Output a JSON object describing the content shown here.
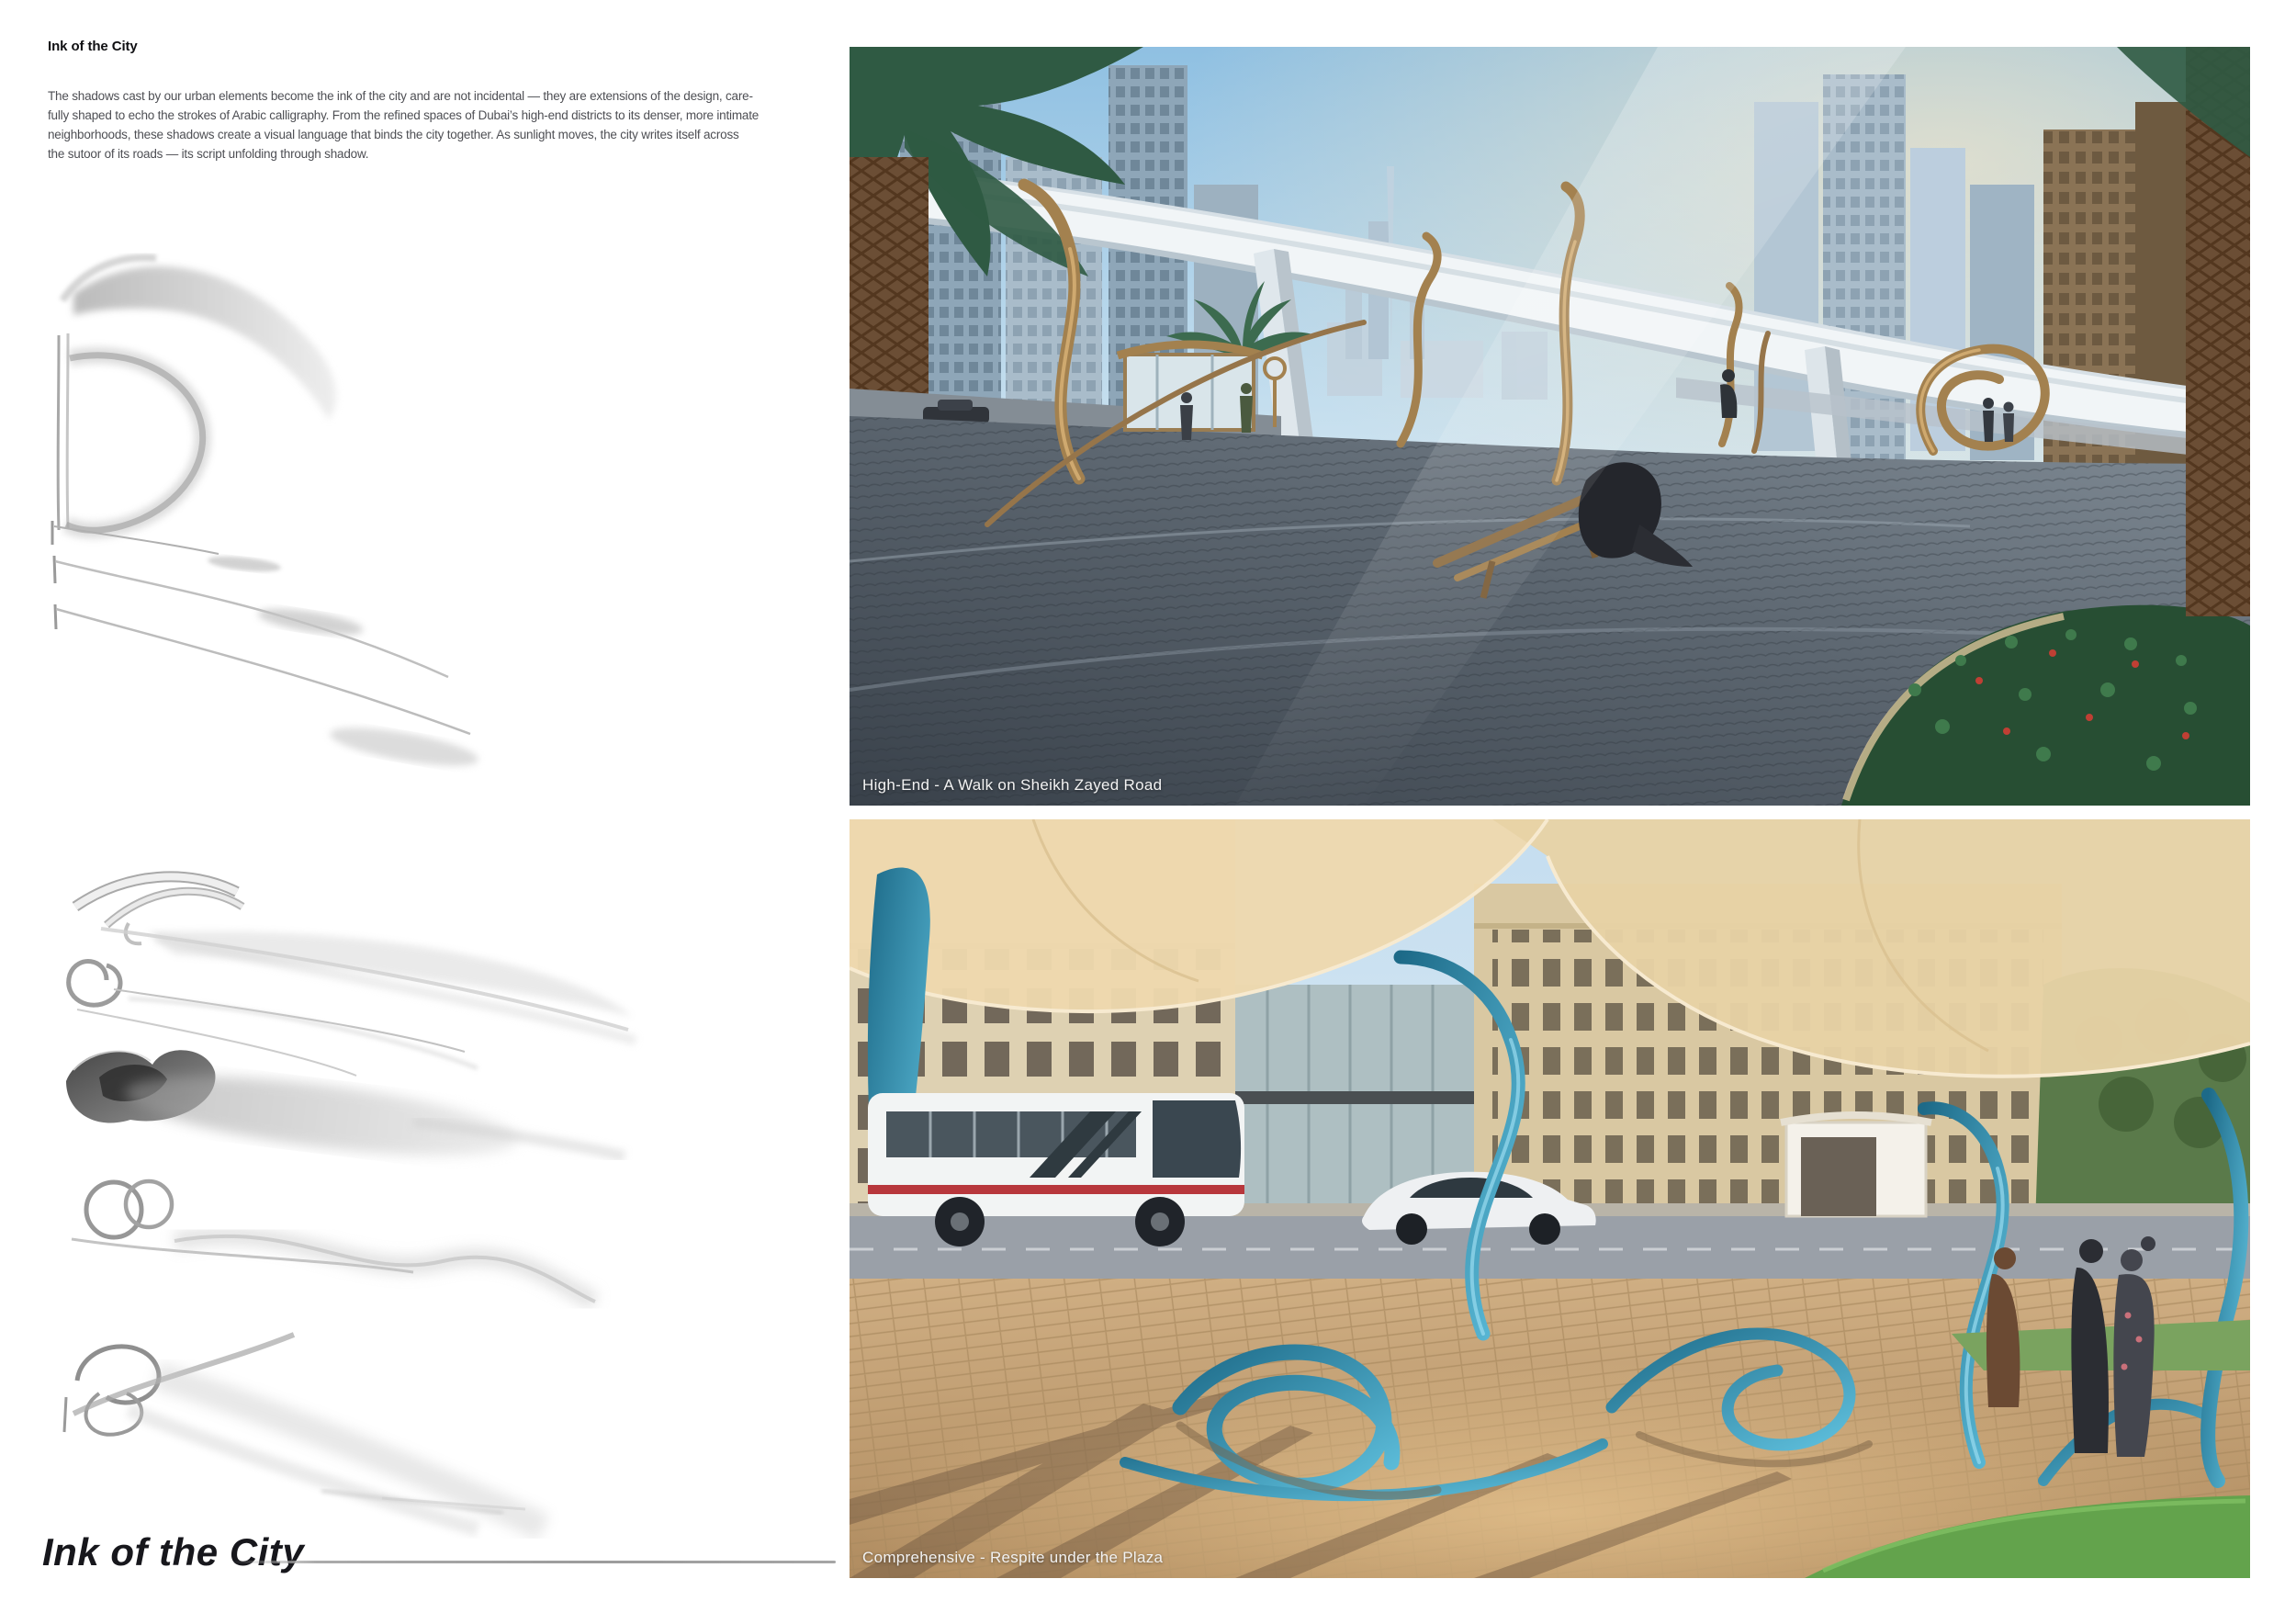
{
  "header": {
    "heading": "Ink of the City"
  },
  "intro": {
    "lines": [
      "The shadows cast by our urban elements become the ink of the city and are not incidental — they are extensions of the design, care-",
      "fully shaped to echo the strokes of Arabic calligraphy. From the refined spaces of Dubai’s high-end districts to its denser, more intimate",
      "neighborhoods, these shadows create a visual language that binds the city together. As sunlight moves, the city writes itself across",
      "the sutoor of its roads — its script unfolding through shadow."
    ]
  },
  "renders": {
    "high_end": {
      "caption": "High-End - A Walk on Sheikh Zayed Road"
    },
    "comprehensive": {
      "caption": "Comprehensive - Respite under the Plaza"
    }
  },
  "footer": {
    "title": "Ink of the City"
  },
  "colors": {
    "heading_text": "#101013",
    "body_text": "#4e4f54",
    "caption_text": "#f2f2f2",
    "rule_gray": "#a5a5a5",
    "bronze_sculpture": "#a3814f",
    "teal_sculpture": "#2e86a8",
    "sky_blue": "#a8cfe8",
    "plaza_tan": "#c7a97c"
  }
}
